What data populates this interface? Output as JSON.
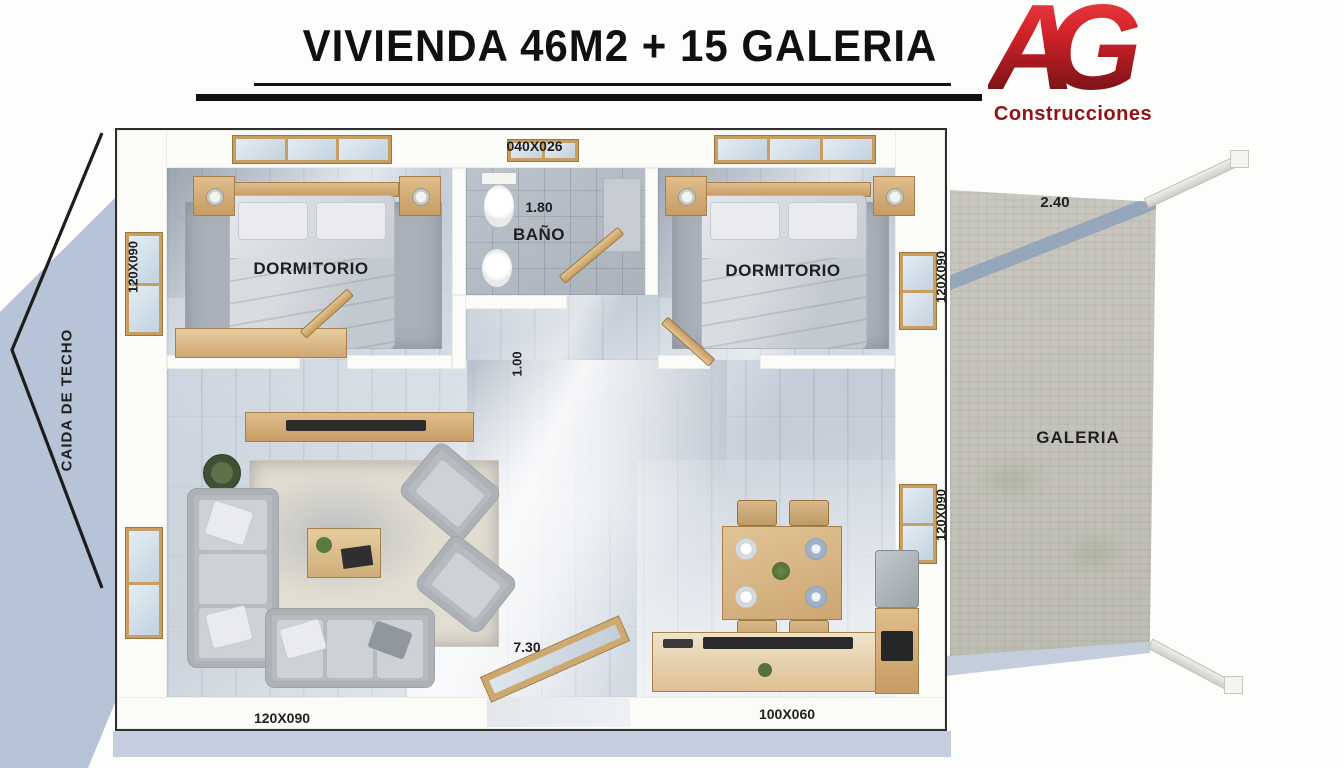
{
  "header": {
    "title": "VIVIENDA 46M2 + 15 GALERIA"
  },
  "logo": {
    "monogram": "AG",
    "subtitle": "Construcciones"
  },
  "plan": {
    "rooms": {
      "bedroom_left": {
        "label": "DORMITORIO"
      },
      "bedroom_right": {
        "label": "DORMITORIO"
      },
      "bathroom": {
        "label": "BAÑO"
      },
      "galeria": {
        "label": "GALERIA"
      }
    },
    "dimensions": {
      "top_window": "040X026",
      "bathroom_width": "1.80",
      "hallway_width": "1.00",
      "left_window": "120X090",
      "right_window_top": "120X090",
      "right_window_bottom": "120X090",
      "galeria_depth": "2.40",
      "interior_width": "7.30",
      "bottom_left_window": "120X090",
      "bottom_right_window": "100X060"
    },
    "annotations": {
      "roof_slope": "CAIDA DE TECHO"
    }
  },
  "colors": {
    "logo_red": "#c4212a",
    "shadow_blue": "#b7c3d6",
    "floor_blue_gray": "#c9d2dc",
    "concrete": "#c5c4bc",
    "line_black": "#1c1c1c"
  }
}
